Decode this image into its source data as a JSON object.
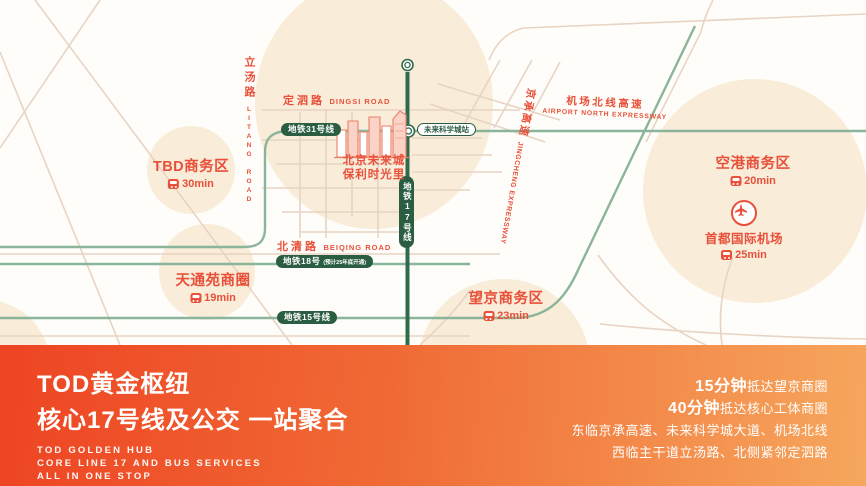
{
  "map": {
    "roads": {
      "dingsi": {
        "zh": "定泗路",
        "en": "DINGSI ROAD"
      },
      "litang": {
        "zh": "立汤路",
        "en": "LITANG ROAD"
      },
      "beiqing": {
        "zh": "北清路",
        "en": "BEIQING ROAD"
      },
      "airport_north": {
        "zh": "机场北线高速",
        "en": "AIRPORT NORTH EXPRESSWAY"
      },
      "jingcheng": {
        "zh": "京承高速",
        "en": "JINGCHENG EXPRESSWAY"
      }
    },
    "metro": {
      "line31_badge": "地铁31号线",
      "line17_badge": "地铁17号线",
      "line18_badge": "地铁18号",
      "line18_note": "(预计25年底开通)",
      "line15_badge": "地铁15号线",
      "station": "未来科学城站"
    },
    "project": {
      "line1": "北京未来城",
      "line2": "保利时光里"
    },
    "districts": [
      {
        "name": "TBD商务区",
        "time": "30min"
      },
      {
        "name": "天通苑商圈",
        "time": "19min"
      },
      {
        "name": "望京商务区",
        "time": "23min"
      },
      {
        "name": "空港商务区",
        "time": "20min"
      }
    ],
    "airport": {
      "name": "首都国际机场",
      "time": "25min"
    }
  },
  "banner": {
    "title_line1": "TOD黄金枢纽",
    "title_line2": "核心17号线及公交 一站聚合",
    "subtitle_en": [
      "TOD GOLDEN HUB",
      "CORE LINE 17 AND BUS SERVICES",
      "ALL IN ONE STOP"
    ],
    "highlights": [
      {
        "bold": "15分钟",
        "rest": "抵达望京商圈"
      },
      {
        "bold": "40分钟",
        "rest": "抵达核心工体商圈"
      },
      {
        "bold": "",
        "rest": "东临京承高速、未来科学城大道、机场北线"
      },
      {
        "bold": "",
        "rest": "西临主干道立汤路、北侧紧邻定泗路"
      }
    ]
  },
  "colors": {
    "accent_red": "#e8503a",
    "dark_green": "#2b5d43",
    "light_green": "#8ab59a",
    "road_tan": "#e8d4c4",
    "circle_beige": "#f9ecd9",
    "banner_left": "#ee4423",
    "banner_right": "#f6a75d"
  }
}
